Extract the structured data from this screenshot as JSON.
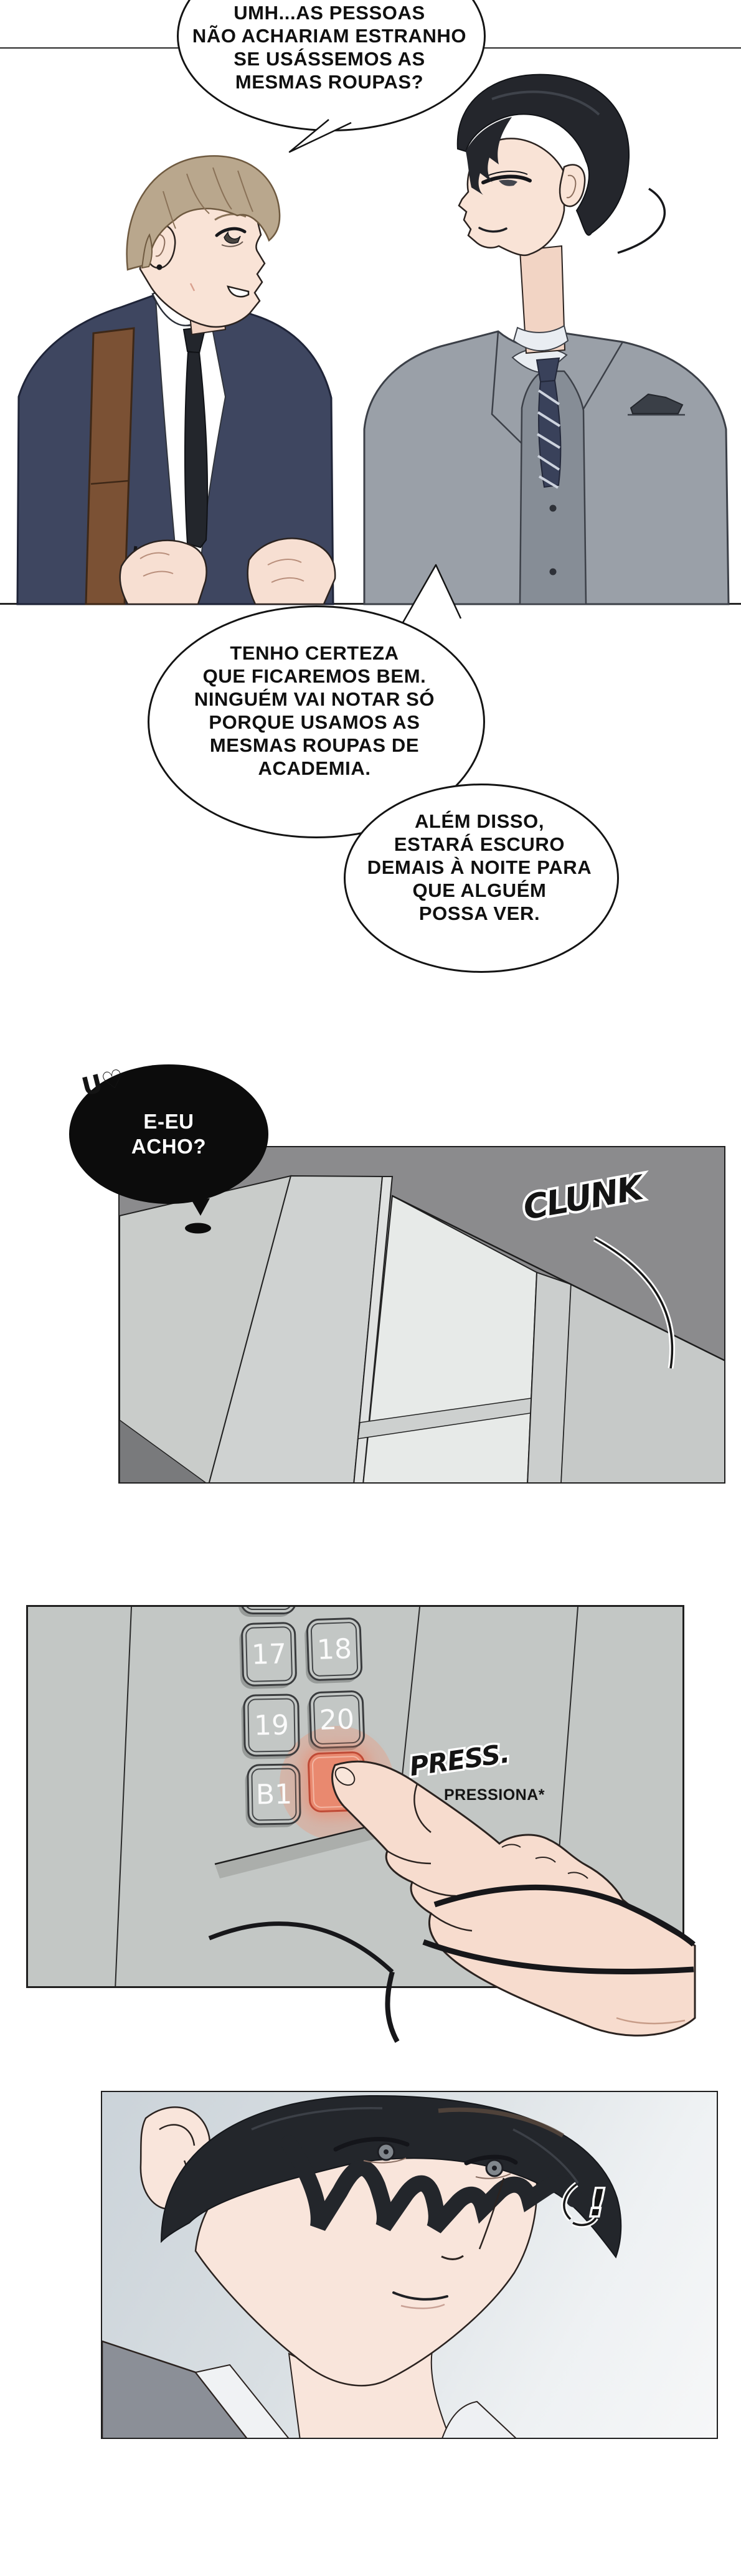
{
  "comic": {
    "language": "pt-BR",
    "speech_bubbles": {
      "b1": {
        "lines": [
          "UMH...AS PESSOAS",
          "NÃO ACHARIAM ESTRANHO",
          "SE USÁSSEMOS AS",
          "MESMAS ROUPAS?"
        ]
      },
      "b2": {
        "lines": [
          "TENHO CERTEZA",
          "QUE FICAREMOS BEM.",
          "NINGUÉM VAI NOTAR SÓ",
          "PORQUE USAMOS AS",
          "MESMAS ROUPAS DE",
          "ACADEMIA."
        ]
      },
      "b3": {
        "lines": [
          "ALÉM DISSO,",
          "ESTARÁ ESCURO",
          "DEMAIS À NOITE PARA",
          "QUE ALGUÉM",
          "POSSA VER."
        ]
      },
      "b4": {
        "lines": [
          "E-EU",
          "ACHO?"
        ],
        "murmur": "U♡"
      }
    },
    "sfx": {
      "clunk": "CLUNK",
      "press": "PRESS.",
      "press_note": "PRESSIONA*",
      "exclaim": "!"
    },
    "elevator_panel": {
      "b17": "17",
      "b18": "18",
      "b19": "19",
      "b20": "20",
      "bb1": "B1",
      "pressed_label": ""
    },
    "colors": {
      "navy_suit": "#3e4660",
      "gray_suit": "#9aa0a8",
      "bag_strap": "#7b5134",
      "blond_hair": "#b9a78d",
      "black_hair": "#24262c",
      "skin": "#f8e0d2",
      "panel2_wall": "#8b8b8d",
      "panel3_wall": "#c3c7c5",
      "pressed_button": "#e9896f",
      "pressed_button_border": "#bf4a36"
    }
  }
}
